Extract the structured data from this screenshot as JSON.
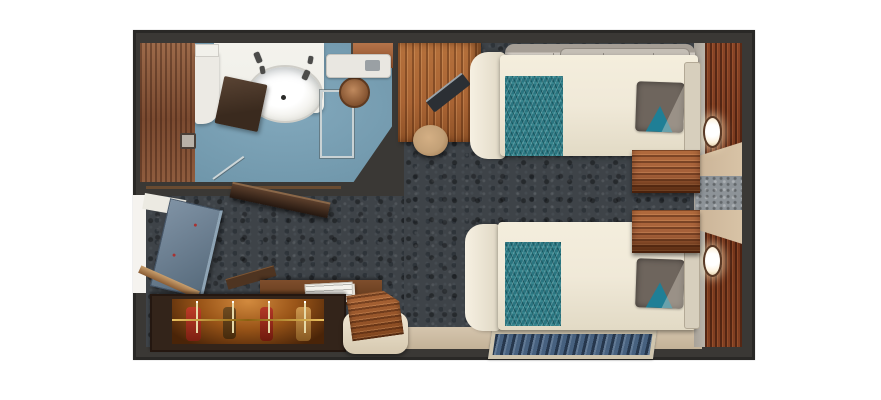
{
  "scene": {
    "type": "cruise-stateroom-floorplan",
    "orientation": "top-down"
  },
  "colors": {
    "background": "#ffffff",
    "wall": "#3a3835",
    "carpet-base": "#3e4348",
    "bathroom-floor": "#83a9bd",
    "wood-desk": "#a96434",
    "wood-night": "#a5603a",
    "closet-wood": "#33241a",
    "closet-glow": "#9a5518",
    "bed-linen": "#f0e9d8",
    "runner-teal": "#2a7580",
    "pillow-gray": "#6e655d",
    "pillow-teal": "#1f7f96",
    "sofa-gray": "#cbc4bb",
    "beige-floor": "#d5c5ad",
    "curtain-beige": "#d8c3a6",
    "glass-gray": "#8d9398",
    "stool-tan": "#c2a077",
    "door-blue": "#6b7e90",
    "rug-blue": "#47617f",
    "rug-border": "#cfc5ae",
    "lamp-cream": "#fdf2dc",
    "white-fixture": "#efeee8",
    "dark-panel": "#3a2a1e"
  },
  "furniture": {
    "bathroom": "Bathroom",
    "sink": "Washbasin",
    "shower": "Shower enclosure",
    "showerhead": "Showerhead",
    "toilet": "Toilet",
    "bathroom_door": "Bathroom door (open)",
    "desk": "Desk",
    "stool": "Stool",
    "sofa": "Sofa berth",
    "bed_upper": "Twin bed (upper)",
    "bed_lower": "Twin bed (lower)",
    "nightstand_upper": "Nightstand (upper)",
    "nightstand_lower": "Nightstand (lower)",
    "window": "Picture window with curtains",
    "lamp": "Reading lamp",
    "wardrobe": "Wardrobe with hangers",
    "entry_door": "Entry door (open)",
    "rug": "Rug",
    "bench": "Luggage bench",
    "papers": "Papers",
    "carpet": "Carpet",
    "beige_floor": "Window-side flooring"
  }
}
